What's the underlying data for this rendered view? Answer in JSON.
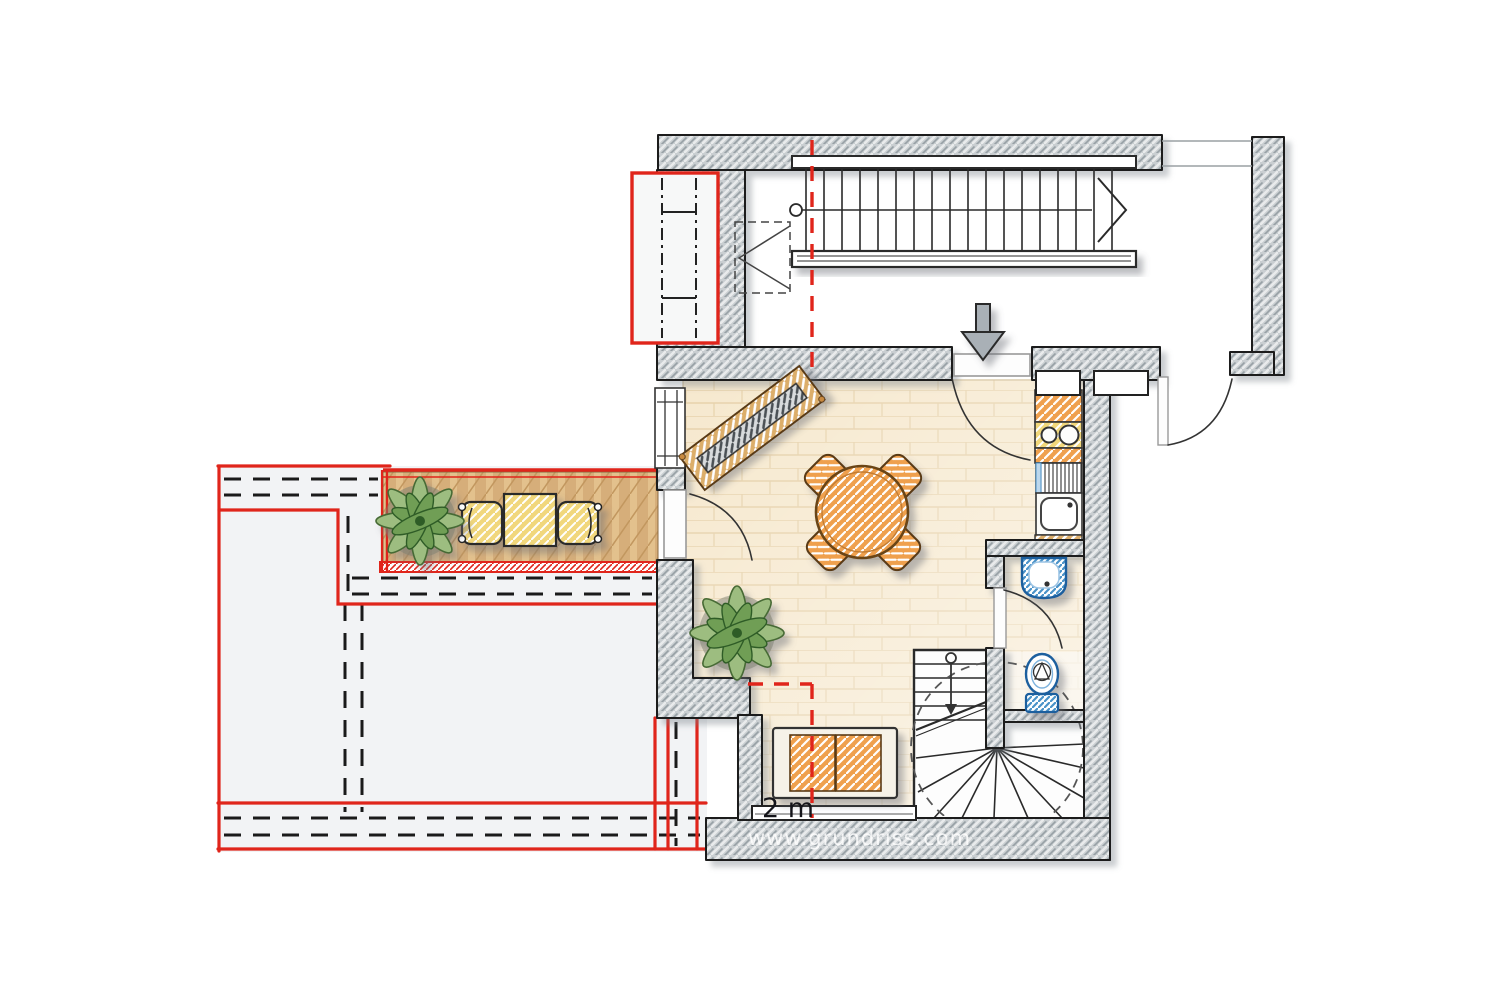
{
  "labels": {
    "scale": "2 m",
    "watermark": "www.grundriss.com"
  },
  "plan": {
    "type": "attic floor plan with proposed roof terrace",
    "rooms": [
      "stair-hall",
      "living-room",
      "kitchenette",
      "bathroom",
      "roof-terrace"
    ],
    "counts": {
      "dining_chairs": 4,
      "hob_burners": 2,
      "terrace_chairs": 2,
      "plants": 2,
      "straight_stair_treads": 18
    },
    "legend": {
      "red_solid": "new / proposed construction",
      "black_dashed": "existing edges below",
      "red_dashed": "2 m headroom line",
      "gray_hatch": "walls",
      "gray_arrow": "entrance"
    }
  },
  "palette": {
    "wall_fill": "#c9ced1",
    "wall_hatch": "#97a0a5",
    "outline": "#1d1d1d",
    "floor": "#f6e8cd",
    "floor_joint": "#e6d0a8",
    "deck": "#d6ae7a",
    "deck_stripe": "#e3c18d",
    "red": "#e0251b",
    "orange": "#ec9b45",
    "yellow": "#f1d77b",
    "plant_green": "#9dbd80",
    "plant_green_dark": "#6f9e55",
    "fixture_blue": "#4a92c8",
    "arrow_gray": "#a9b0b6",
    "roof_area": "#f2f3f5"
  }
}
